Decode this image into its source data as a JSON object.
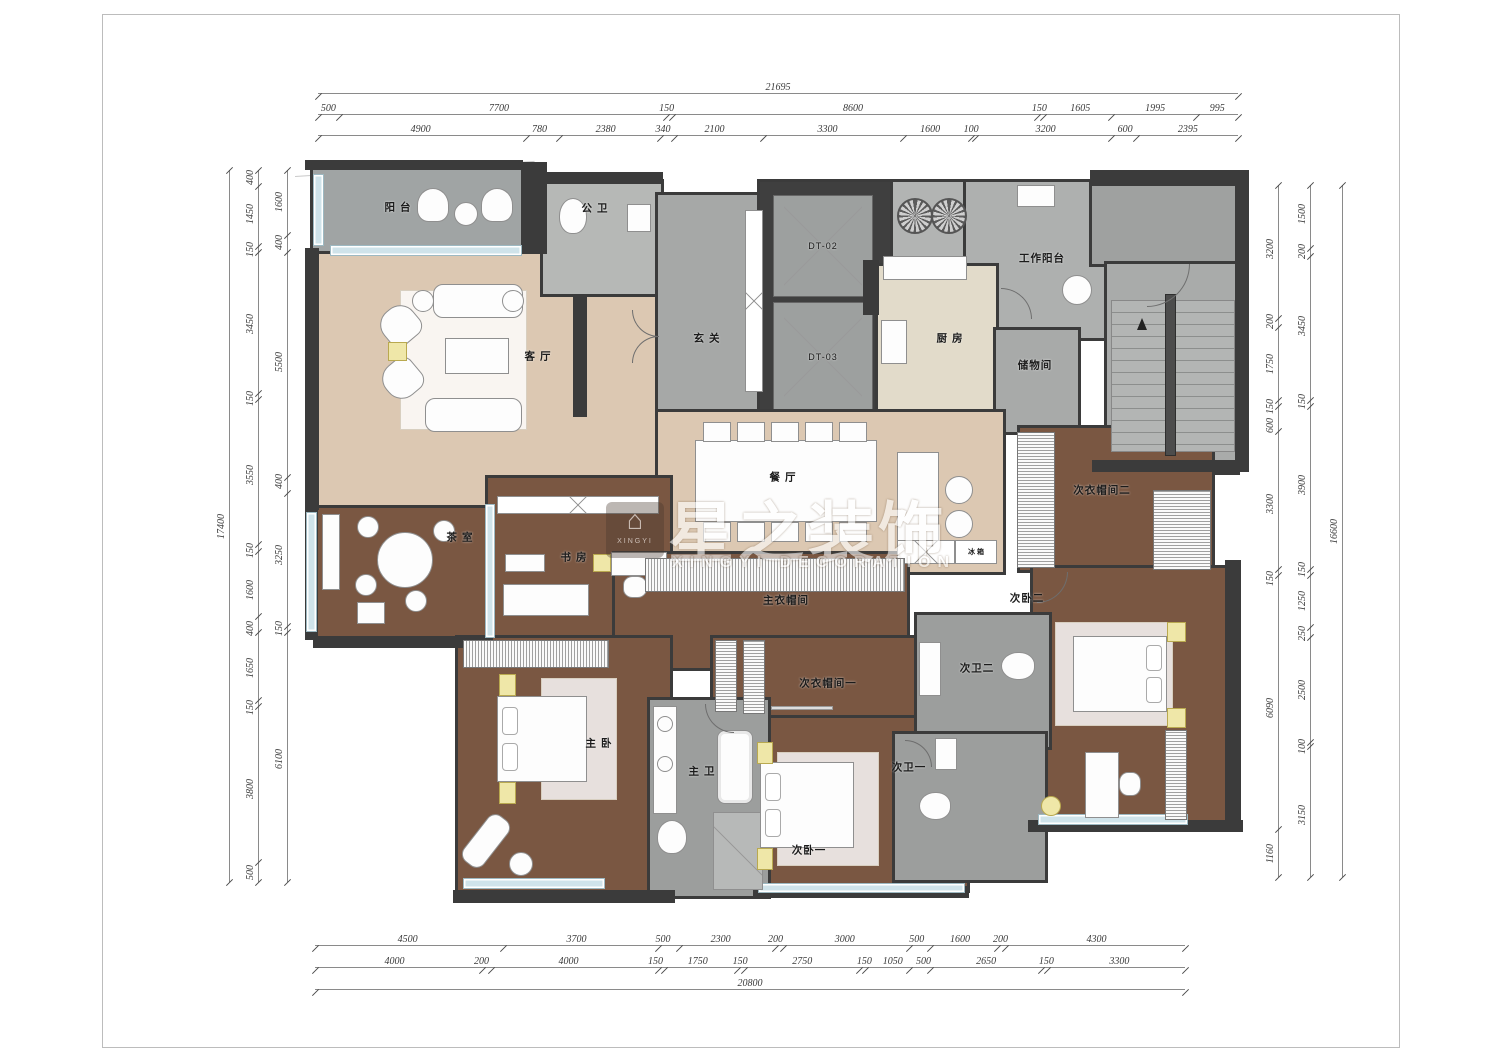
{
  "watermark": {
    "logo_glyph": "⌂",
    "logo_text": "XINGYI",
    "title": "星之装饰",
    "subtitle": "XINGYI DECORATION"
  },
  "rooms": {
    "balcony": "阳 台",
    "public_bath": "公 卫",
    "living": "客 厅",
    "foyer": "玄 关",
    "elevator_1": "DT-02",
    "elevator_2": "DT-03",
    "work_balcony": "工作阳台",
    "kitchen": "厨 房",
    "storage": "储物间",
    "dining": "餐 厅",
    "fridge": "冰 箱",
    "closet_2": "次衣帽间二",
    "bedroom_2": "次卧二",
    "tea_room": "茶 室",
    "study": "书 房",
    "master_closet": "主衣帽间",
    "closet_1": "次衣帽间一",
    "master_bedroom": "主 卧",
    "master_bath": "主 卫",
    "bath_2": "次卫二",
    "bath_1": "次卫一",
    "bedroom_1": "次卧一"
  },
  "dimensions": {
    "top_total": [
      21695
    ],
    "top_row2": [
      500,
      7700,
      150,
      8600,
      150,
      1605,
      1995,
      995
    ],
    "top_row3": [
      4900,
      780,
      2380,
      340,
      2100,
      3300,
      1600,
      100,
      3200,
      600,
      2395
    ],
    "bottom_row1": [
      4500,
      3700,
      500,
      2300,
      200,
      3000,
      500,
      1600,
      200,
      4300
    ],
    "bottom_row2": [
      4000,
      200,
      4000,
      150,
      1750,
      150,
      2750,
      150,
      1050,
      500,
      2650,
      150,
      3300
    ],
    "bottom_total": [
      20800
    ],
    "left_outer": [
      17400
    ],
    "left_mid": [
      400,
      1450,
      150,
      3450,
      150,
      3550,
      150,
      1600,
      400,
      1650,
      150,
      3800,
      500
    ],
    "left_inner": [
      1600,
      400,
      5500,
      400,
      3250,
      150,
      6100
    ],
    "right_inner": [
      3200,
      200,
      1750,
      150,
      600,
      3300,
      150,
      6090,
      1160
    ],
    "right_mid": [
      1500,
      200,
      3450,
      150,
      3900,
      150,
      1250,
      250,
      2500,
      100,
      3150
    ],
    "right_outer": [
      16600
    ]
  },
  "colors": {
    "wall": "#3b3b3b",
    "floor_beige": "#dcc8b2",
    "floor_wood": "#7a5742",
    "floor_gray": "#a8aaa9",
    "window": "#cfe3ea",
    "lamp": "#efe7a8"
  }
}
